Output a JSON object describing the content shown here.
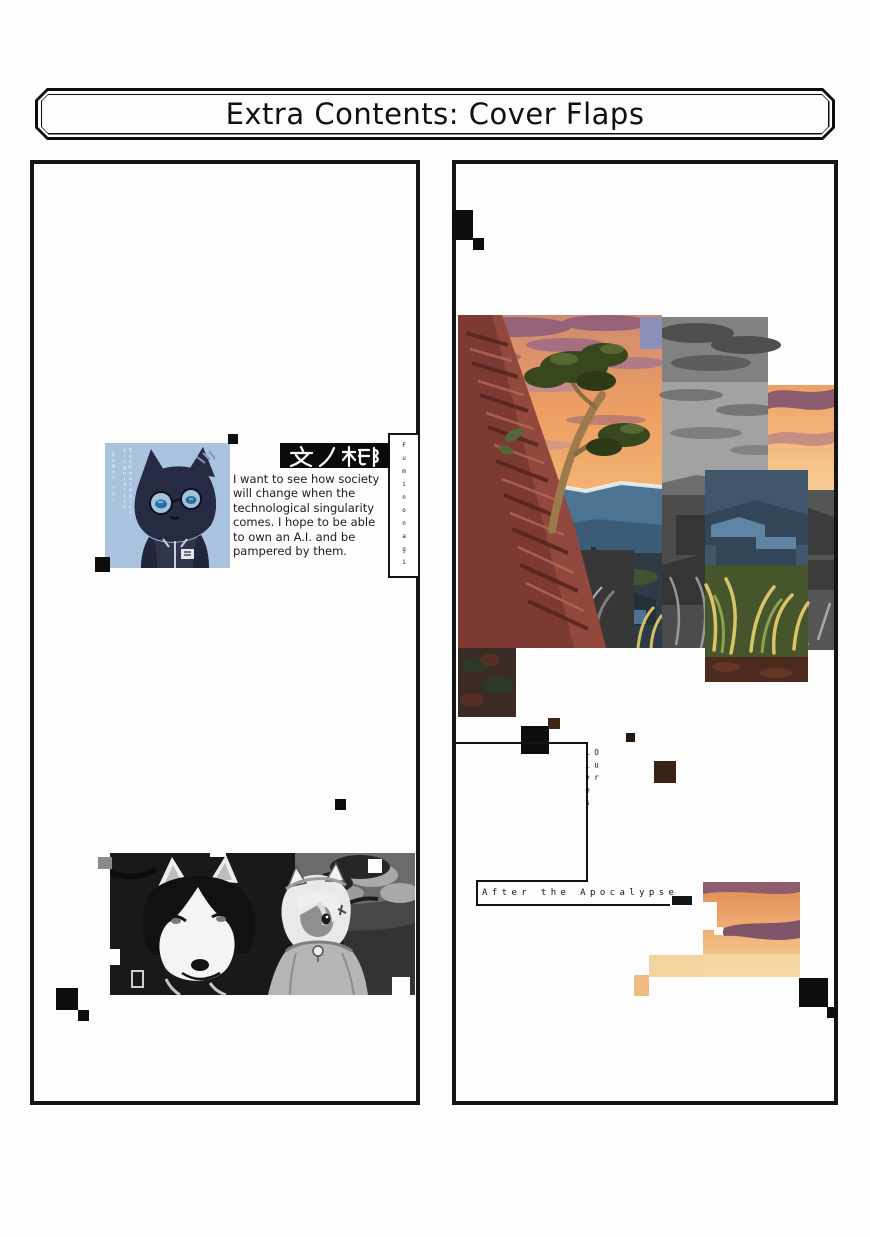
{
  "page": {
    "banner_title": "Extra Contents: Cover Flaps"
  },
  "left_flap": {
    "author_name_jp": "文ノ梛",
    "author_name_romaji": "Fuminonagi",
    "portrait_caption_col1": "Eager for",
    "portrait_caption_col2": "Technological Singularity",
    "quote": "I want to see how society\nwill change when the\ntechnological singularity\ncomes. I hope to be able\nto own an A.I. and be\npampered by them."
  },
  "right_flap": {
    "series_title_vertical": "Our Lives",
    "series_title_horizontal": "After the Apocalypse"
  },
  "colors": {
    "panel_border": "#141414",
    "portrait_background_blue": "#a9c3de",
    "sunset_orange": "#f0a263",
    "cloud_purple": "#96627a",
    "brick_red": "#7d3a33"
  }
}
